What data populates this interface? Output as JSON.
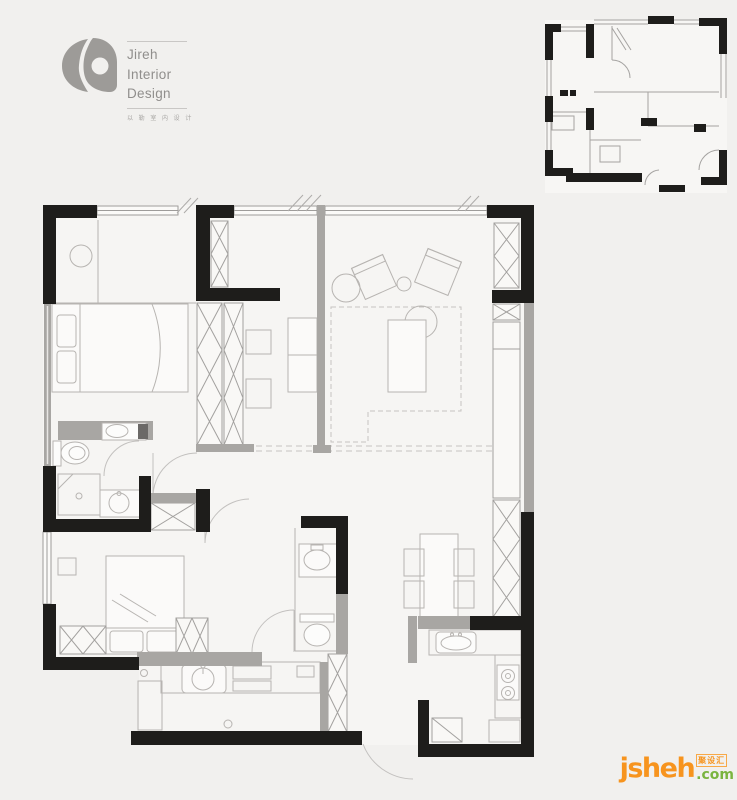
{
  "page": {
    "background_color": "#f1f0ee"
  },
  "logo": {
    "name_line1": "Jireh",
    "name_line2": "Interior",
    "name_line3": "Design",
    "tagline": "以 勒 室 内 设 计",
    "color": "#908e8c"
  },
  "watermark": {
    "site_name": "jsheh",
    "site_tld": ".com",
    "badge_text": "聚设汇",
    "orange": "#f7941e",
    "green": "#7ab43f"
  },
  "plan_colors": {
    "wall_black": "#1e1d1b",
    "wall_gray": "#a8a6a3",
    "line_gray": "#b7b4b1",
    "floor": "#f6f5f3"
  }
}
